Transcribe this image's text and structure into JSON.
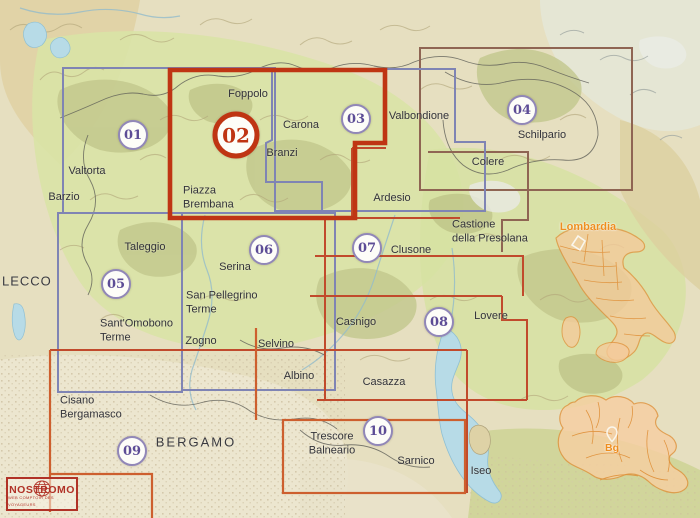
{
  "title": "Map index of hiking sheets - Bergamo Alps (Lombardia)",
  "sheets": [
    {
      "number": "01"
    },
    {
      "number": "02",
      "highlighted": true
    },
    {
      "number": "03"
    },
    {
      "number": "04"
    },
    {
      "number": "05"
    },
    {
      "number": "06"
    },
    {
      "number": "07"
    },
    {
      "number": "08"
    },
    {
      "number": "09"
    },
    {
      "number": "10"
    }
  ],
  "places": [
    {
      "name": "Foppolo"
    },
    {
      "name": "Carona"
    },
    {
      "name": "Branzi"
    },
    {
      "name": "Valtorta"
    },
    {
      "name": "Barzio"
    },
    {
      "name": "Piazza\nBrembana"
    },
    {
      "name": "Valbondione"
    },
    {
      "name": "Schilpario"
    },
    {
      "name": "Colere"
    },
    {
      "name": "Ardesio"
    },
    {
      "name": "Castione\ndella Presolana"
    },
    {
      "name": "Clusone"
    },
    {
      "name": "Taleggio"
    },
    {
      "name": "Serina"
    },
    {
      "name": "San Pellegrino\nTerme"
    },
    {
      "name": "Sant'Omobono\nTerme"
    },
    {
      "name": "Zogno"
    },
    {
      "name": "Selvino"
    },
    {
      "name": "Casnigo"
    },
    {
      "name": "Lovere"
    },
    {
      "name": "Albino"
    },
    {
      "name": "Casazza"
    },
    {
      "name": "Cisano\nBergamasco"
    },
    {
      "name": "Trescore\nBalneario"
    },
    {
      "name": "Sarnico"
    },
    {
      "name": "Iseo"
    }
  ],
  "cities": [
    {
      "name": "LECCO"
    },
    {
      "name": "BERGAMO"
    }
  ],
  "inset": {
    "region_label": "Lombardia",
    "province_label": "Bg"
  },
  "logo": {
    "name": "NOSTROMO",
    "tagline": "WEB COMPTOIR DES VOYAGEURS"
  },
  "colors": {
    "sheet_highlight_red": "#bf3513",
    "sheet_blue": "#7f84b4",
    "sheet_brown": "#8f6553",
    "sheet_thin_red": "#c14a2c",
    "sheet_orange": "#cd5f2e",
    "circle_purple": "#5d4d96",
    "inset_orange": "#e0923c",
    "lake_blue": "#b7dbe7"
  }
}
